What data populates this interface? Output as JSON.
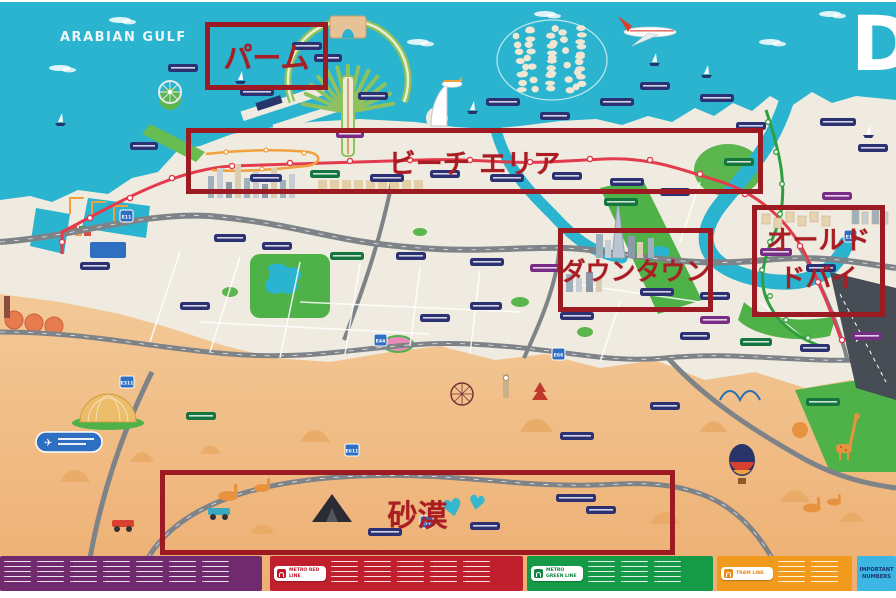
{
  "map": {
    "sea_label": "ARABIAN GULF",
    "brand_letter": "D",
    "annotations": {
      "palm": "パーム",
      "beach": "ビーチ エリア",
      "downtown": "ダウンタウン",
      "old_dubai_line1": "オールド",
      "old_dubai_line2": "ドバイ",
      "desert": "砂漠"
    },
    "road_shields": [
      "E11",
      "E44",
      "E66",
      "E77",
      "E311",
      "E611",
      "E11"
    ],
    "colors": {
      "sea": "#2ab4cf",
      "land": "#f0ebe0",
      "sand_top": "#f3c997",
      "sand_bottom": "#edaf73",
      "annotation_red": "#9c1a21",
      "metro_red_line": "#e23b4e",
      "metro_green_line": "#2f9e3f",
      "tram_line": "#f0a03c",
      "road_gray": "#7e8388"
    }
  },
  "legend": {
    "metro_red_label": "METRO RED LINE",
    "metro_green_label": "METRO GREEN LINE",
    "tram_label": "TRAM LINE",
    "important_numbers_label": "IMPORTANT NUMBERS"
  }
}
